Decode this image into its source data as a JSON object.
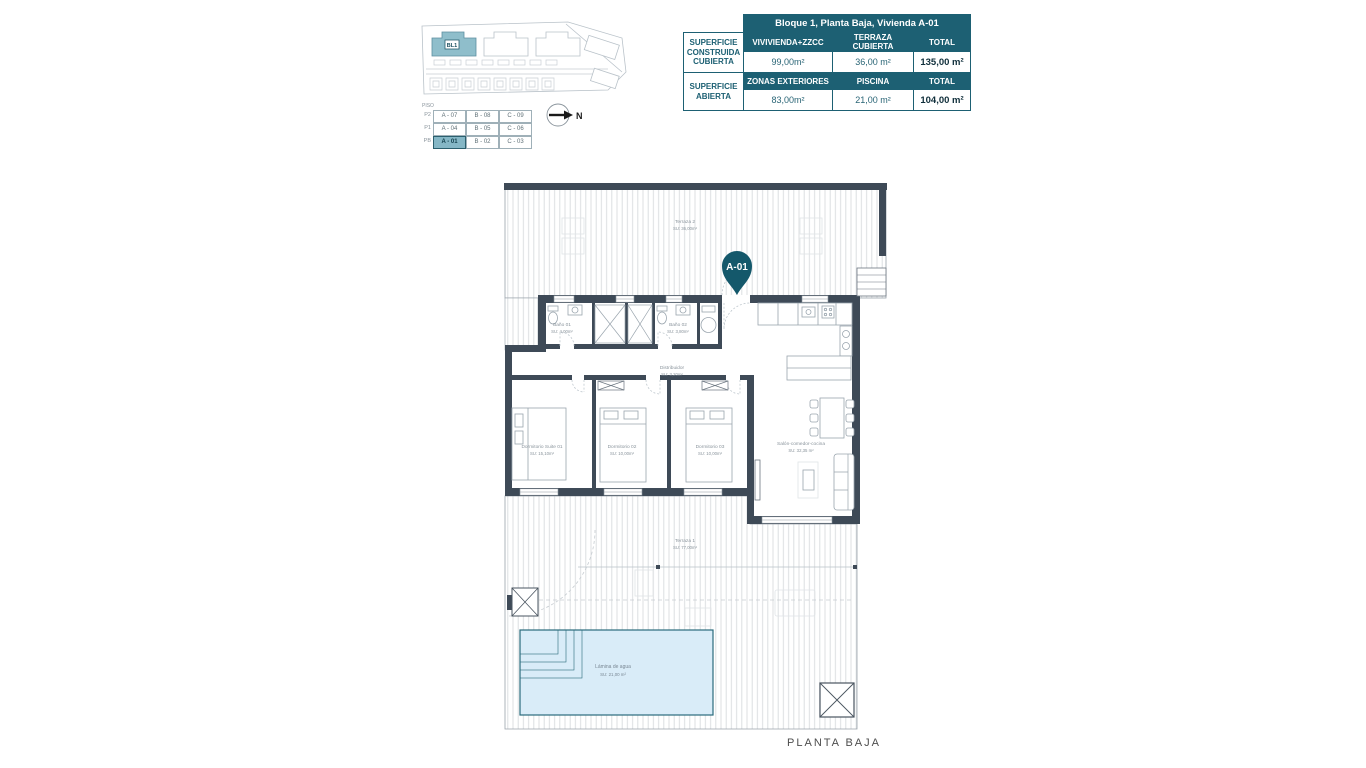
{
  "colors": {
    "accent_teal": "#1d6073",
    "wall": "#3e4a57",
    "building_highlight": "#8fbecb",
    "pool_fill": "#d9ecf8",
    "pin": "#14586b"
  },
  "site_plan": {
    "block_label": "BL1"
  },
  "floors_table": {
    "corner_label": "PISO",
    "rows": [
      {
        "floor": "P2",
        "units": [
          "A - 07",
          "B - 08",
          "C - 09"
        ]
      },
      {
        "floor": "P1",
        "units": [
          "A - 04",
          "B - 05",
          "C - 06"
        ]
      },
      {
        "floor": "PB",
        "units": [
          "A - 01",
          "B - 02",
          "C - 03"
        ]
      }
    ]
  },
  "compass": {
    "letter": "N"
  },
  "summary_table": {
    "title": "Bloque 1, Planta Baja, Vivienda A-01",
    "row1": {
      "label": "SUPERFICIE CONSTRUIDA CUBIERTA",
      "col1_header": "VIVIVIENDA+ZZCC",
      "col2_header": "TERRAZA CUBIERTA",
      "col3_header": "TOTAL",
      "col1_value": "99,00m²",
      "col2_value": "36,00 m²",
      "col3_value": "135,00 m²"
    },
    "row2": {
      "label": "SUPERFICIE ABIERTA",
      "col1_header": "ZONAS EXTERIORES",
      "col2_header": "PISCINA",
      "col3_header": "TOTAL",
      "col1_value": "83,00m²",
      "col2_value": "21,00 m²",
      "col3_value": "104,00 m²"
    }
  },
  "plan": {
    "pin_label": "A-01",
    "rooms": {
      "terraza2": {
        "name": "Terraza 2",
        "area": "SU: 36,00m²"
      },
      "banyo1": {
        "name": "Baño 01",
        "area": "SU: 4,00m²"
      },
      "banyo2": {
        "name": "Baño 02",
        "area": "SU: 3,80m²"
      },
      "distribuidor": {
        "name": "Distribuidor",
        "area": "SU: 3,20m²"
      },
      "suite": {
        "name": "Dormitorio Suite 01",
        "area": "SU: 15,10m²"
      },
      "dorm2": {
        "name": "Dormitorio 02",
        "area": "SU: 10,00m²"
      },
      "dorm3": {
        "name": "Dormitorio 03",
        "area": "SU: 10,00m²"
      },
      "salon": {
        "name": "Salón-comedor-cocina",
        "area": "SU: 32,35 m²"
      },
      "terraza1": {
        "name": "Terraza 1",
        "area": "SU: 77,00m²"
      },
      "pool": {
        "name": "Lámina de agua",
        "area": "SU: 21,00 m²"
      }
    }
  },
  "footer": {
    "title": "PLANTA BAJA"
  }
}
